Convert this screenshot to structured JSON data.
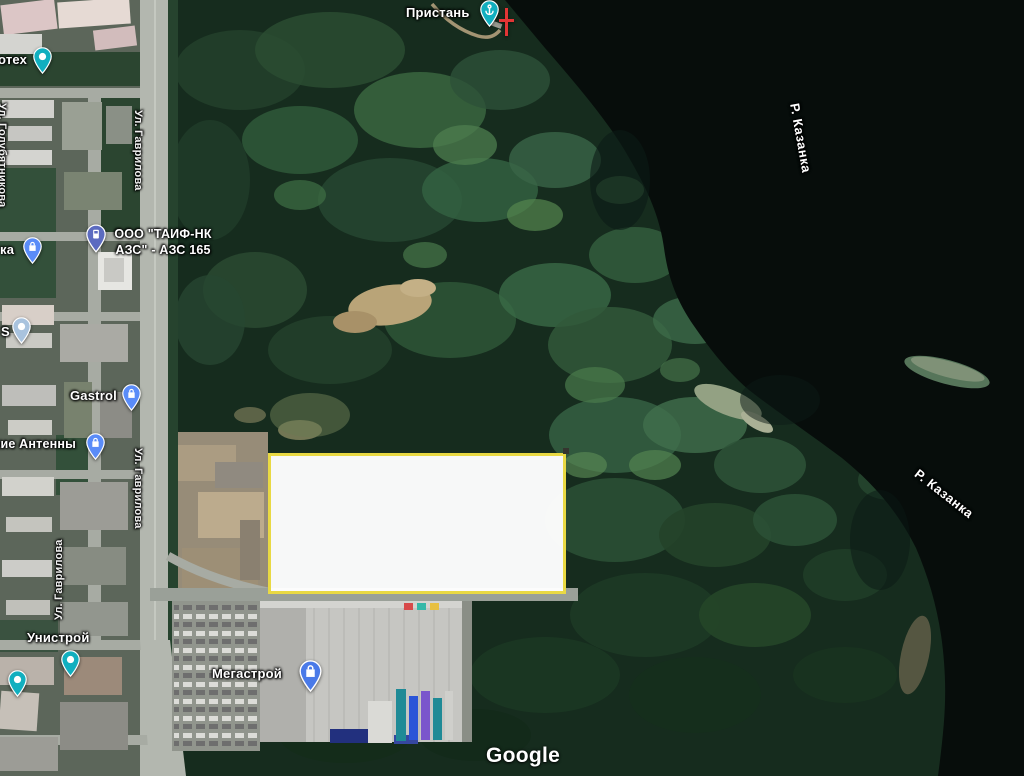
{
  "map": {
    "attribution": "Google",
    "highlight": {
      "fill": "#ffffff",
      "border": "#e9d943"
    },
    "labels": {
      "pristan": "Пристань",
      "otekh": "отех",
      "ka": "ка",
      "taif_line1": "ООО \"ТАИФ-НК",
      "taif_line2": "АЗС\" - АЗС 165",
      "s": "S",
      "gastrol": "Gastrol",
      "antenny": "кие Антенны",
      "gavrilova": "Ул. Гаврилова",
      "golubyatnikova": "Ул. Голубятникова",
      "unistroy": "Унистрой",
      "megastroy": "Мегастрой",
      "kazanka": "Р. Казанка"
    },
    "pins": {
      "pristan": {
        "color": "#11AFBF",
        "type": "harbor"
      },
      "otekh": {
        "color": "#11AFBF",
        "type": "place"
      },
      "ka": {
        "color": "#5A8CF8",
        "type": "shop"
      },
      "taif": {
        "color": "#5C6BC0",
        "type": "gas-station"
      },
      "s": {
        "color": "#A9C3DE",
        "type": "place"
      },
      "gastrol": {
        "color": "#5A8CF8",
        "type": "shop"
      },
      "antenny": {
        "color": "#5A8CF8",
        "type": "shop"
      },
      "unistroy_a": {
        "color": "#11AFBF",
        "type": "place"
      },
      "unistroy_b": {
        "color": "#11AFBF",
        "type": "place"
      },
      "megastroy": {
        "color": "#4A7AE8",
        "type": "store"
      }
    },
    "pier_marker_color": "#e23535"
  }
}
